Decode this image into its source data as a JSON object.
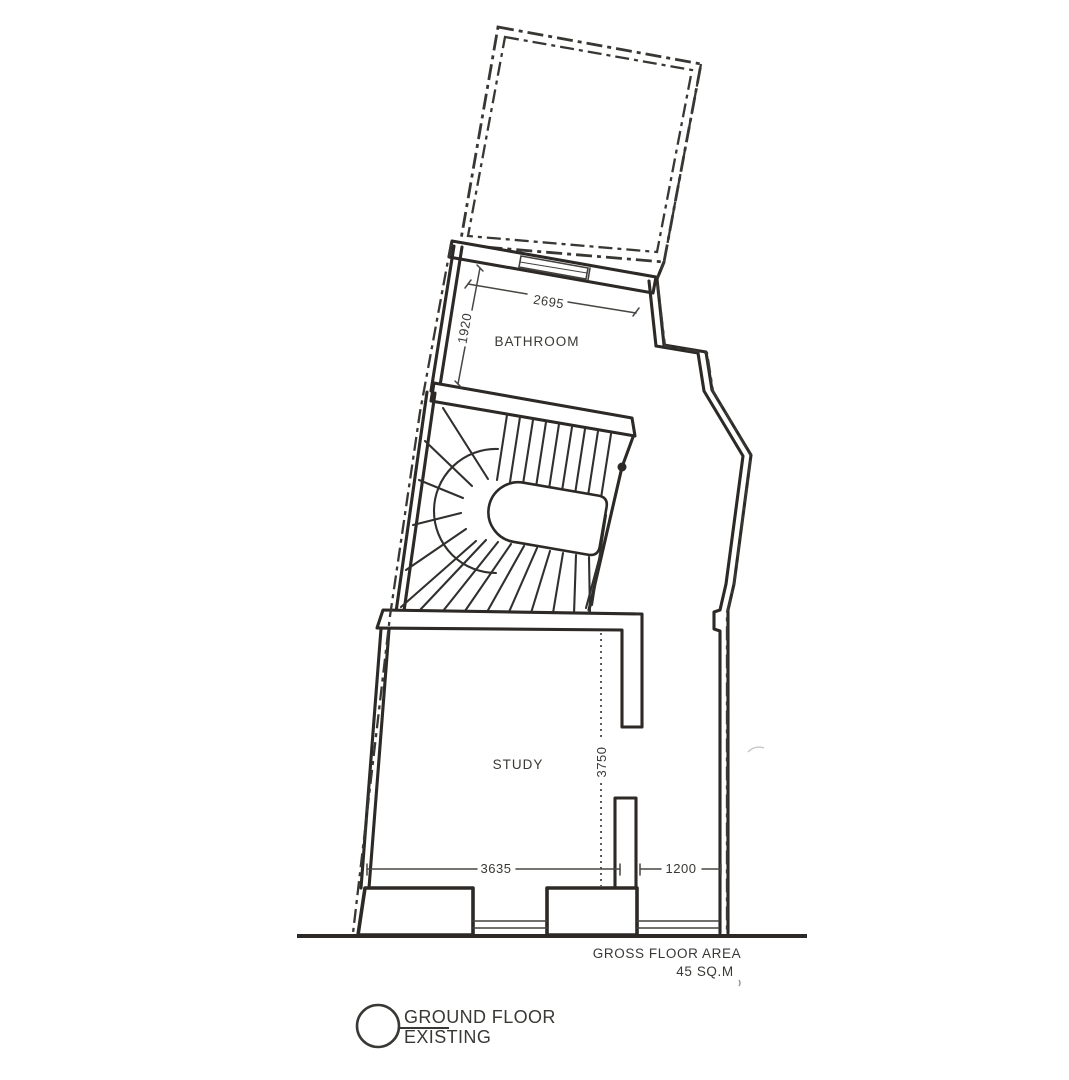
{
  "plan": {
    "rooms": [
      {
        "label": "BATHROOM"
      },
      {
        "label": "STUDY"
      }
    ],
    "dims": {
      "bathroom_width": "2695",
      "bathroom_depth": "1920",
      "study_depth": "3750",
      "study_width": "3635",
      "entry_width": "1200"
    },
    "notes": {
      "area_label": "GROSS FLOOR AREA",
      "area_value": "45 SQ.M"
    },
    "legend": {
      "line1": "GROUND FLOOR",
      "line2": "EXISTING"
    },
    "colors": {
      "ink": "#2e2c29",
      "paper": "#ffffff"
    }
  }
}
